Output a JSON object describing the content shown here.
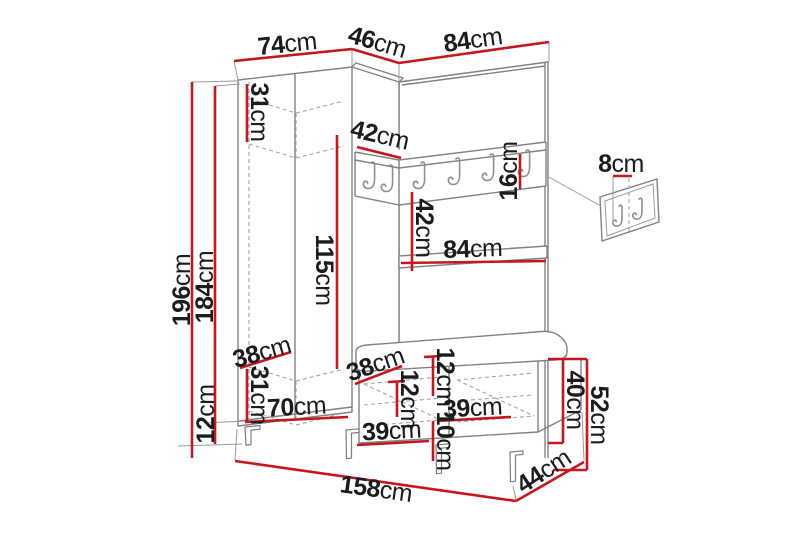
{
  "diagram": {
    "type": "furniture-dimension-drawing",
    "subject": "hallway wardrobe set with coat rack, shelf, bench and wall hook panel",
    "unit": "cm",
    "colors": {
      "dimension_line": "#c8161d",
      "structure_line": "#828282",
      "hidden_edge_line": "#a5a5a5",
      "text": "#1c1c1c",
      "background": "#ffffff"
    },
    "hook_rail": {
      "hook_count": 6
    },
    "wall_hook_panel": {
      "hook_count": 2
    }
  },
  "labels": {
    "wardrobe_width": {
      "value": "74",
      "unit": "cm"
    },
    "wardrobe_depth": {
      "value": "46",
      "unit": "cm"
    },
    "panel_width": {
      "value": "84",
      "unit": "cm"
    },
    "top_compartment_height": {
      "value": "31",
      "unit": "cm"
    },
    "hook_shelf_depth": {
      "value": "42",
      "unit": "cm"
    },
    "hook_rail_height": {
      "value": "16",
      "unit": "cm"
    },
    "wall_panel_depth": {
      "value": "8",
      "unit": "cm"
    },
    "total_height": {
      "value": "196",
      "unit": "cm"
    },
    "carcass_height": {
      "value": "184",
      "unit": "cm"
    },
    "hanging_space_height": {
      "value": "115",
      "unit": "cm"
    },
    "rail_to_shelf_gap": {
      "value": "42",
      "unit": "cm"
    },
    "shelf_width": {
      "value": "84",
      "unit": "cm"
    },
    "wardrobe_shelf_depth": {
      "value": "38",
      "unit": "cm"
    },
    "bottom_compartment_height": {
      "value": "31",
      "unit": "cm"
    },
    "wardrobe_interior_width": {
      "value": "70",
      "unit": "cm"
    },
    "leg_height": {
      "value": "12",
      "unit": "cm"
    },
    "bench_seat_depth": {
      "value": "38",
      "unit": "cm"
    },
    "seat_inset_height": {
      "value": "12",
      "unit": "cm"
    },
    "bench_compartment_height": {
      "value": "12",
      "unit": "cm"
    },
    "bench_compartment_width": {
      "value": "39",
      "unit": "cm"
    },
    "bench_bottom_clearance": {
      "value": "10",
      "unit": "cm"
    },
    "bench_left_compartment_width": {
      "value": "39",
      "unit": "cm"
    },
    "bench_body_height": {
      "value": "40",
      "unit": "cm"
    },
    "bench_total_height": {
      "value": "52",
      "unit": "cm"
    },
    "total_width": {
      "value": "158",
      "unit": "cm"
    },
    "total_depth": {
      "value": "44",
      "unit": "cm"
    }
  }
}
